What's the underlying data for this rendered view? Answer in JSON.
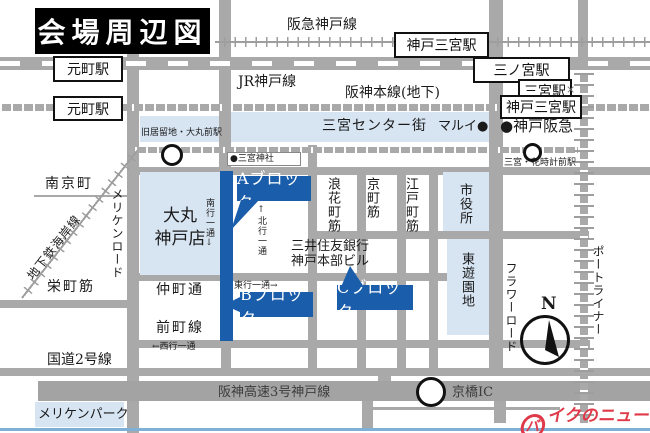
{
  "title": "会場周辺図",
  "rail": {
    "hankyu": "阪急神戸線",
    "jr": "JR神戸線",
    "hanshin": "阪神本線(地下)",
    "subway_kaigan": "地下鉄海岸線",
    "portliner": "ポートライナー"
  },
  "stations": {
    "motomachi_jr": "元町駅",
    "motomachi_hanshin": "元町駅",
    "kobe_sannomiya_hankyu": "神戸三宮駅",
    "sannomiya_jr": "三ノ宮駅",
    "sannomiya_subway": "三宮駅",
    "kobe_sannomiya_hanshin": "神戸三宮駅",
    "kyukyoryuchi_daimarumae": "旧居留地・大丸前駅",
    "sannomiya_hanadokei_mae": "三宮・花時計前駅"
  },
  "landmarks": {
    "sannomiya_shrine": "●三宮神社",
    "marui": "マルイ●",
    "kobe_hankyu": "●神戸阪急",
    "sannomiya_center_gai": "三宮センター街",
    "nankinmachi": "南京町",
    "daimaru_line1": "大丸",
    "daimaru_line2": "神戸店",
    "smbc_line1": "三井住友銀行",
    "smbc_line2": "神戸本部ビル",
    "city_hall": "市役所",
    "higashi_yuenchi": "東遊園地",
    "meriken_park": "メリケンパーク"
  },
  "streets": {
    "meriken_road": "メリケンロード",
    "sakaemachi_suji": "栄町筋",
    "route2": "国道2号線",
    "nakamachi_dori": "仲町通",
    "maemachi_sen": "前町線",
    "naniwamachi_suji": "浪花町筋",
    "kyomachi_suji": "京町筋",
    "edomachi_suji": "江戸町筋",
    "flower_road": "フラワーロード",
    "hanshin_expressway": "阪神高速3号神戸線",
    "kyobashi_ic": "京橋IC"
  },
  "oneway": {
    "south": "南行一通↓",
    "north": "↑北行一通",
    "east": "東行一通→",
    "west": "←西行一通"
  },
  "blocks": {
    "a": "Aブロック",
    "b": "Bブロック",
    "c": "Cブロック"
  },
  "compass": {
    "n": "N"
  },
  "line_end_mark": "×",
  "logo": {
    "first": "バ",
    "rest": "イクのニュース"
  },
  "colors": {
    "callout_blue": "#1a5dab",
    "block_fill": "#d7e4f2",
    "road_gray": "#a9a9a9",
    "logo_red": "#e0394a"
  }
}
